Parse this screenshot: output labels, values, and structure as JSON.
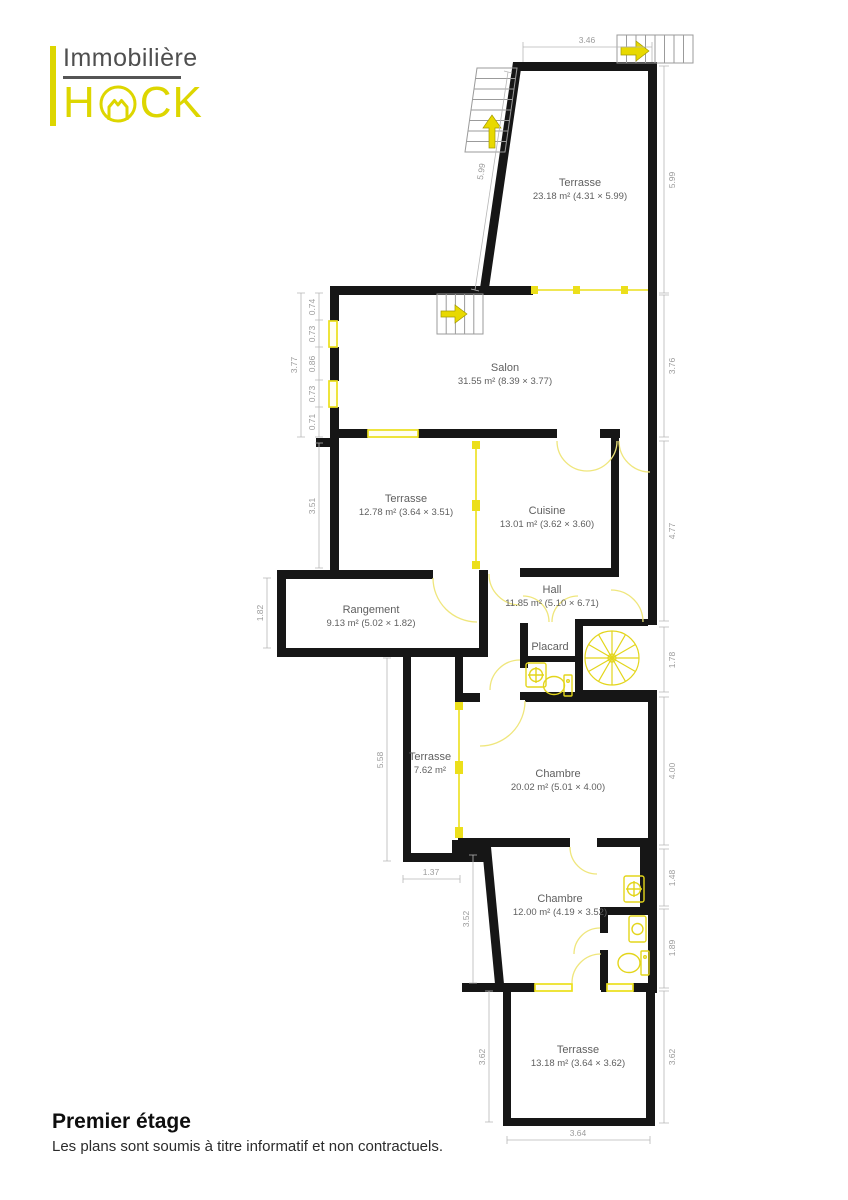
{
  "logo": {
    "brand_top": "Immobilière",
    "brand_h": "H",
    "brand_ck": "CK"
  },
  "rooms": {
    "terrasse_top": {
      "name": "Terrasse",
      "details": "23.18 m² (4.31 × 5.99)"
    },
    "salon": {
      "name": "Salon",
      "details": "31.55 m² (8.39 × 3.77)"
    },
    "terrasse_mid": {
      "name": "Terrasse",
      "details": "12.78 m² (3.64 × 3.51)"
    },
    "cuisine": {
      "name": "Cuisine",
      "details": "13.01 m² (3.62 × 3.60)"
    },
    "hall": {
      "name": "Hall",
      "details": "11.85 m² (5.10 × 6.71)"
    },
    "rangement": {
      "name": "Rangement",
      "details": "9.13 m² (5.02 × 1.82)"
    },
    "placard": {
      "name": "Placard"
    },
    "terrasse_small": {
      "name": "Terrasse",
      "details": "7.62 m²"
    },
    "chambre_1": {
      "name": "Chambre",
      "details": "20.02 m² (5.01 × 4.00)"
    },
    "chambre_2": {
      "name": "Chambre",
      "details": "12.00 m² (4.19 × 3.52)"
    },
    "terrasse_bottom": {
      "name": "Terrasse",
      "details": "13.18 m² (3.64 × 3.62)"
    }
  },
  "dimensions": {
    "top": "3.46",
    "left_slant": "5.99",
    "right": [
      "5.99",
      "3.76",
      "4.77",
      "1.78",
      "4.00",
      "1.48",
      "1.89",
      "3.62"
    ],
    "salon_total": "3.77",
    "salon_segments": [
      "0.74",
      "0.73",
      "0.86",
      "0.73",
      "0.71"
    ],
    "terrasse_mid": "3.51",
    "rangement": "1.82",
    "terrasse_small_height": "5.58",
    "terrasse_small_width": "1.37",
    "chambre2_left": "3.52",
    "terrasse_bottom_left": "3.62",
    "terrasse_bottom_right": "3.62",
    "terrasse_bottom_width": "3.64"
  },
  "colors": {
    "accent": "#ddd600",
    "wall": "#161616",
    "dim_text": "#9b9b9b"
  },
  "footer": {
    "title": "Premier étage",
    "disclaimer": "Les plans sont soumis à titre informatif et non contractuels."
  }
}
